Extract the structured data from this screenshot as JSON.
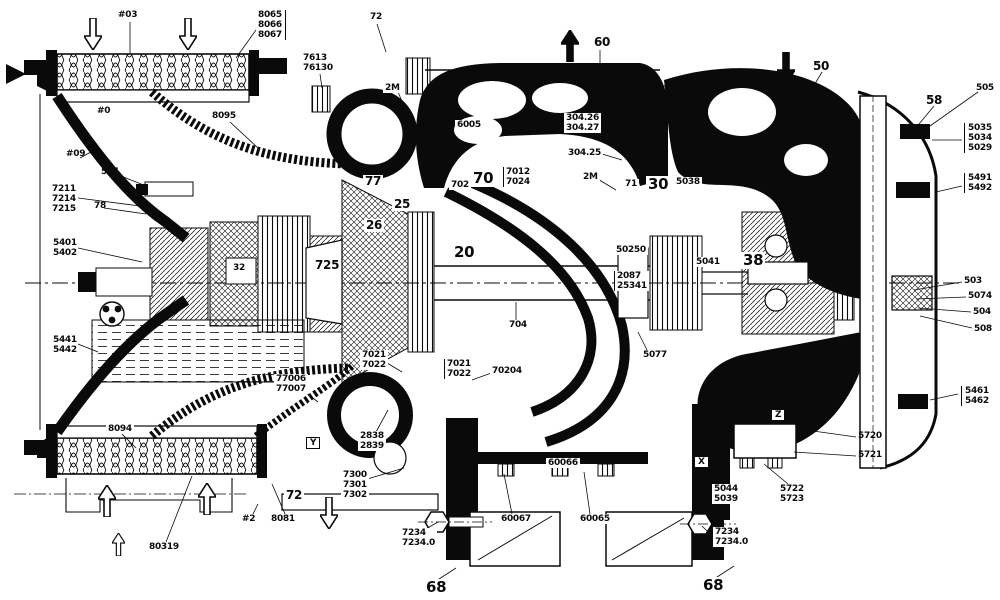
{
  "figure": {
    "type": "engine-cross-section-diagram",
    "description": "Cutaway engineering drawing of a turbomachine (compressor/turbine with gearbox) with part callouts",
    "background": "#ffffff",
    "ink": "#0a0a0a"
  },
  "labels": [
    {
      "text": "#03",
      "x": 118,
      "y": 10,
      "size": "s"
    },
    {
      "text": "8065\n8066\n8067",
      "x": 258,
      "y": 10,
      "size": "s",
      "bracket": "right"
    },
    {
      "text": "72",
      "x": 370,
      "y": 12,
      "size": "s"
    },
    {
      "text": "7613\n76130",
      "x": 303,
      "y": 53,
      "size": "s"
    },
    {
      "text": "2M",
      "x": 383,
      "y": 83,
      "size": "s",
      "bg": true
    },
    {
      "text": "6005",
      "x": 455,
      "y": 120,
      "size": "s",
      "bg": true
    },
    {
      "text": "60",
      "x": 594,
      "y": 36,
      "size": "m"
    },
    {
      "text": "304.26\n304.27",
      "x": 564,
      "y": 113,
      "size": "s",
      "bracket": "right",
      "bg": true
    },
    {
      "text": "304.25",
      "x": 566,
      "y": 148,
      "size": "s",
      "bg": true
    },
    {
      "text": "2M",
      "x": 581,
      "y": 172,
      "size": "s",
      "bg": true
    },
    {
      "text": "50",
      "x": 813,
      "y": 60,
      "size": "m"
    },
    {
      "text": "58",
      "x": 926,
      "y": 94,
      "size": "m"
    },
    {
      "text": "505",
      "x": 976,
      "y": 83,
      "size": "s"
    },
    {
      "text": "5035\n5034\n5029",
      "x": 964,
      "y": 123,
      "size": "s",
      "bracket": "left"
    },
    {
      "text": "5491\n5492",
      "x": 964,
      "y": 173,
      "size": "s",
      "bracket": "left"
    },
    {
      "text": "#0",
      "x": 97,
      "y": 106,
      "size": "s"
    },
    {
      "text": "8095",
      "x": 212,
      "y": 111,
      "size": "s"
    },
    {
      "text": "#09",
      "x": 66,
      "y": 149,
      "size": "s"
    },
    {
      "text": "505",
      "x": 101,
      "y": 167,
      "size": "s"
    },
    {
      "text": "7211\n7214\n7215",
      "x": 52,
      "y": 184,
      "size": "s"
    },
    {
      "text": "78",
      "x": 94,
      "y": 201,
      "size": "s"
    },
    {
      "text": "5401\n5402",
      "x": 53,
      "y": 238,
      "size": "s"
    },
    {
      "text": "5441\n5442",
      "x": 53,
      "y": 335,
      "size": "s"
    },
    {
      "text": "77",
      "x": 363,
      "y": 175,
      "size": "m",
      "bg": true
    },
    {
      "text": "25",
      "x": 392,
      "y": 198,
      "size": "m",
      "bg": true
    },
    {
      "text": "26",
      "x": 364,
      "y": 219,
      "size": "m",
      "bg": true
    },
    {
      "text": "702",
      "x": 449,
      "y": 180,
      "size": "s",
      "bg": true
    },
    {
      "text": "70",
      "x": 471,
      "y": 170,
      "size": "l",
      "bg": true
    },
    {
      "text": "7012\n7024",
      "x": 503,
      "y": 167,
      "size": "s",
      "bracket": "left",
      "bg": true
    },
    {
      "text": "71",
      "x": 623,
      "y": 179,
      "size": "s",
      "bg": true
    },
    {
      "text": "30",
      "x": 646,
      "y": 176,
      "size": "l",
      "bg": true
    },
    {
      "text": "5038",
      "x": 674,
      "y": 177,
      "size": "s",
      "bg": true
    },
    {
      "text": "20",
      "x": 452,
      "y": 244,
      "size": "l",
      "bg": true
    },
    {
      "text": "725",
      "x": 313,
      "y": 259,
      "size": "m",
      "bg": true
    },
    {
      "text": "32",
      "x": 231,
      "y": 263,
      "size": "s",
      "bg": true
    },
    {
      "text": "50250",
      "x": 614,
      "y": 245,
      "size": "s",
      "bg": true
    },
    {
      "text": "2087\n25341",
      "x": 614,
      "y": 271,
      "size": "s",
      "bracket": "left",
      "bg": true
    },
    {
      "text": "5041",
      "x": 694,
      "y": 257,
      "size": "s",
      "bg": true
    },
    {
      "text": "38",
      "x": 741,
      "y": 252,
      "size": "l",
      "bg": true
    },
    {
      "text": "704",
      "x": 507,
      "y": 320,
      "size": "s",
      "bg": true
    },
    {
      "text": "70204",
      "x": 490,
      "y": 366,
      "size": "s",
      "bg": true
    },
    {
      "text": "7021\n7022",
      "x": 360,
      "y": 350,
      "size": "s",
      "bg": true
    },
    {
      "text": "7021\n7022",
      "x": 444,
      "y": 359,
      "size": "s",
      "bracket": "left",
      "bg": true
    },
    {
      "text": "5077",
      "x": 641,
      "y": 350,
      "size": "s",
      "bg": true
    },
    {
      "text": "77006\n77007",
      "x": 274,
      "y": 374,
      "size": "s",
      "bg": true
    },
    {
      "text": "2838\n2839",
      "x": 358,
      "y": 431,
      "size": "s",
      "bg": true
    },
    {
      "text": "7300\n7301\n7302",
      "x": 341,
      "y": 470,
      "size": "s",
      "bg": true
    },
    {
      "text": "72",
      "x": 284,
      "y": 489,
      "size": "m",
      "bg": true
    },
    {
      "text": "8081",
      "x": 269,
      "y": 514,
      "size": "s",
      "bg": true
    },
    {
      "text": "#2",
      "x": 240,
      "y": 514,
      "size": "s",
      "bg": true
    },
    {
      "text": "8094",
      "x": 106,
      "y": 424,
      "size": "s",
      "bg": true
    },
    {
      "text": "80319",
      "x": 149,
      "y": 542,
      "size": "s"
    },
    {
      "text": "60066",
      "x": 546,
      "y": 458,
      "size": "s",
      "bg": true
    },
    {
      "text": "60067",
      "x": 499,
      "y": 514,
      "size": "s",
      "bg": true
    },
    {
      "text": "60065",
      "x": 578,
      "y": 514,
      "size": "s",
      "bg": true
    },
    {
      "text": "7234\n7234.0",
      "x": 400,
      "y": 528,
      "size": "s",
      "bg": true
    },
    {
      "text": "7234\n7234.0",
      "x": 712,
      "y": 527,
      "size": "s",
      "bracket": "left",
      "bg": true
    },
    {
      "text": "68",
      "x": 424,
      "y": 579,
      "size": "l",
      "bg": true
    },
    {
      "text": "68",
      "x": 701,
      "y": 577,
      "size": "l",
      "bg": true
    },
    {
      "text": "5044\n5039",
      "x": 712,
      "y": 484,
      "size": "s",
      "bg": true
    },
    {
      "text": "5722\n5723",
      "x": 778,
      "y": 484,
      "size": "s",
      "bg": true
    },
    {
      "text": "5720",
      "x": 858,
      "y": 431,
      "size": "s"
    },
    {
      "text": "5721",
      "x": 858,
      "y": 450,
      "size": "s"
    },
    {
      "text": "503",
      "x": 964,
      "y": 276,
      "size": "s"
    },
    {
      "text": "5074",
      "x": 968,
      "y": 291,
      "size": "s"
    },
    {
      "text": "504",
      "x": 973,
      "y": 307,
      "size": "s"
    },
    {
      "text": "508",
      "x": 974,
      "y": 324,
      "size": "s"
    },
    {
      "text": "5461\n5462",
      "x": 961,
      "y": 386,
      "size": "s",
      "bracket": "left"
    },
    {
      "text": "Y",
      "x": 306,
      "y": 437,
      "boxed": true,
      "name": "section-marker-y"
    },
    {
      "text": "X",
      "x": 694,
      "y": 456,
      "boxed": true,
      "name": "section-marker-x"
    },
    {
      "text": "Z",
      "x": 771,
      "y": 409,
      "boxed": true,
      "name": "section-marker-z"
    }
  ],
  "arrows": [
    {
      "dir": "down",
      "x": 84,
      "y": 18,
      "style": "outline"
    },
    {
      "dir": "down",
      "x": 179,
      "y": 18,
      "style": "outline"
    },
    {
      "dir": "up",
      "x": 561,
      "y": 30,
      "style": "solid"
    },
    {
      "dir": "down",
      "x": 777,
      "y": 52,
      "style": "solid"
    },
    {
      "dir": "up",
      "x": 98,
      "y": 485,
      "style": "outline"
    },
    {
      "dir": "up",
      "x": 198,
      "y": 483,
      "style": "outline"
    },
    {
      "dir": "up",
      "x": 112,
      "y": 533,
      "style": "outline",
      "small": true
    },
    {
      "dir": "down",
      "x": 320,
      "y": 497,
      "style": "outline"
    }
  ]
}
